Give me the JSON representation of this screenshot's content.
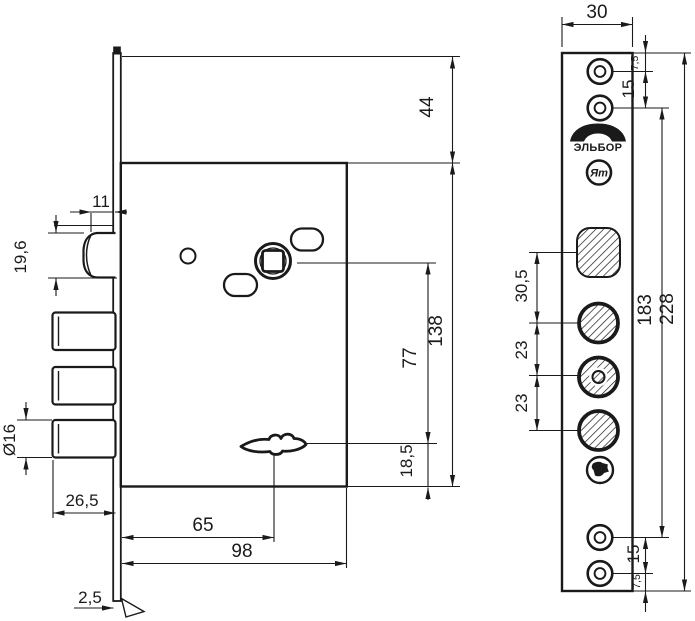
{
  "drawing": {
    "kind": "mortise-lock dimension drawing",
    "ink_color": "#1a1a1a",
    "bg_color": "#ffffff"
  },
  "dims": {
    "side": {
      "latch_protrusion": "11",
      "latch_height": "19,6",
      "bolt_diameter": "Ø16",
      "bolt_length": "26,5",
      "keyhole_backset": "65",
      "body_width": "98",
      "plate_thickness": "2,5",
      "top_to_body": "44",
      "spindle_to_keyhole": "77",
      "body_height": "138",
      "keyhole_to_bottom": "18,5"
    },
    "front": {
      "plate_width": "30",
      "top_screw_edge": "7,5",
      "top_screw_pitch": "15",
      "latch_to_bolt1": "30,5",
      "bolt_pitch_1": "23",
      "bolt_pitch_2": "23",
      "screw_span": "183",
      "plate_height": "228",
      "bottom_screw_pitch": "15",
      "bottom_screw_edge": "7,5"
    }
  },
  "brand": {
    "logo": "ЭЛЬБОР",
    "mark": "Ят"
  }
}
